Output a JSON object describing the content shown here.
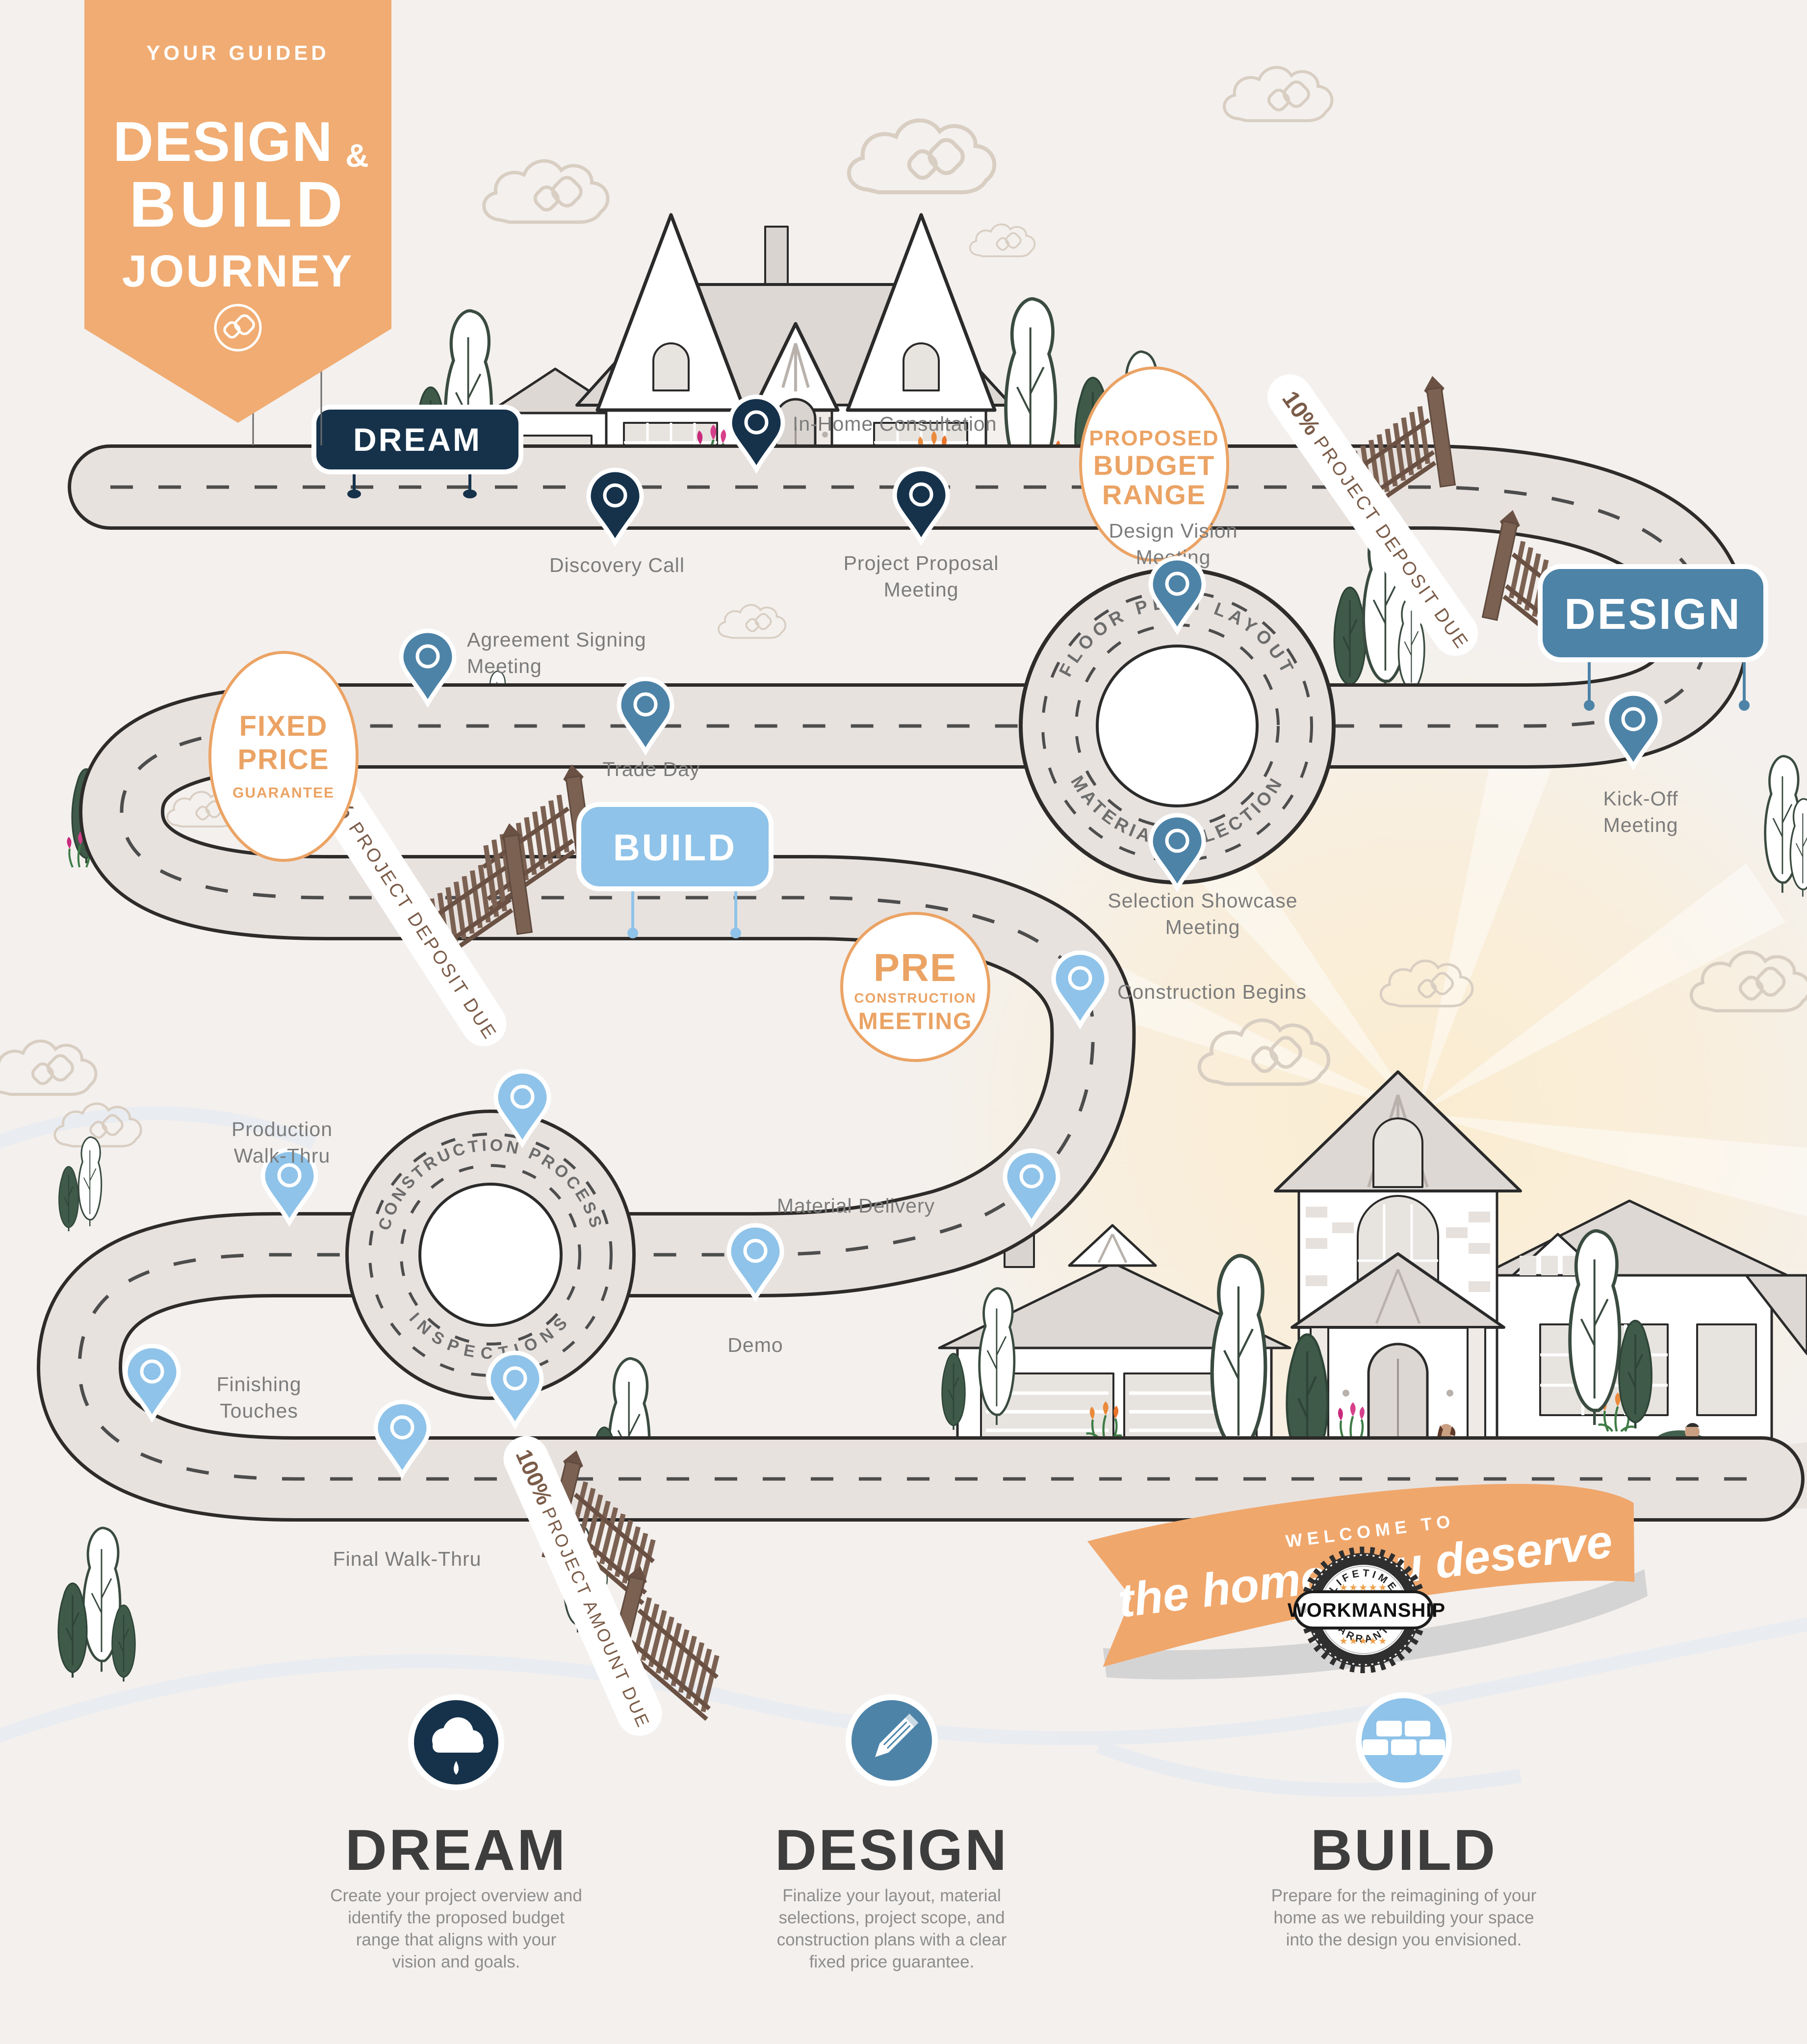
{
  "banner": {
    "kicker": "YOUR GUIDED",
    "line1": "DESIGN",
    "amp": "&",
    "line2": "BUILD",
    "line3": "JOURNEY",
    "logo_icon": "cb-monogram-icon"
  },
  "signs": {
    "dream": "DREAM",
    "design": "DESIGN",
    "build": "BUILD"
  },
  "milestones": {
    "in_home": "In-Home Consultation",
    "discovery": "Discovery Call",
    "proposal1": "Project Proposal",
    "proposal2": "Meeting",
    "design_vision1": "Design Vision",
    "design_vision2": "Meeting",
    "kick_off1": "Kick-Off",
    "kick_off2": "Meeting",
    "agreement1": "Agreement Signing",
    "agreement2": "Meeting",
    "trade_day": "Trade Day",
    "selection1": "Selection Showcase",
    "selection2": "Meeting",
    "construction_begins": "Construction Begins",
    "material_delivery": "Material Delivery",
    "demo": "Demo",
    "production1": "Production",
    "production2": "Walk-Thru",
    "finishing1": "Finishing",
    "finishing2": "Touches",
    "final_walk": "Final Walk-Thru"
  },
  "badges": {
    "budget": {
      "l1": "PROPOSED",
      "l2": "BUDGET",
      "l3": "RANGE"
    },
    "fixed": {
      "l1": "FIXED",
      "l2": "PRICE",
      "l3": "GUARANTEE"
    },
    "pre": {
      "l1": "PRE",
      "l2": "CONSTRUCTION",
      "l3": "MEETING"
    }
  },
  "payments": {
    "p10": {
      "pct": "10%",
      "label": "PROJECT DEPOSIT DUE"
    },
    "p50": {
      "pct": "50%",
      "label": "PROJECT DEPOSIT DUE"
    },
    "p100": {
      "pct": "100%",
      "label": "PROJECT AMOUNT DUE"
    }
  },
  "roundabouts": {
    "r1": {
      "top": "FLOOR PLAN LAYOUT",
      "bottom": "MATERIAL SELECTION"
    },
    "r2": {
      "top": "CONSTRUCTION PROCESS",
      "bottom": "INSPECTIONS"
    }
  },
  "ribbon": {
    "line1": "WELCOME TO",
    "line2": "the home you deserve"
  },
  "seal": {
    "top": "LIFETIME",
    "center": "WORKMANSHIP",
    "bottom": "WARRANTY",
    "stars_top": "★★★★★",
    "stars_bottom": "★★★★★"
  },
  "footer": {
    "dream": {
      "title": "DREAM",
      "icon": "cloud-icon",
      "lines": [
        "Create your project overview and",
        "identify the proposed budget",
        "range that aligns with your",
        "vision and goals."
      ]
    },
    "design": {
      "title": "DESIGN",
      "icon": "pencil-icon",
      "lines": [
        "Finalize your layout, material",
        "selections, project scope, and",
        "construction plans with a clear",
        "fixed price guarantee."
      ]
    },
    "build": {
      "title": "BUILD",
      "icon": "bricks-icon",
      "lines": [
        "Prepare for the reimagining of your",
        "home as we rebuilding your space",
        "into the design you envisioned."
      ]
    }
  },
  "colors": {
    "accent_orange": "#f0ac72",
    "navy": "#16324b",
    "steel_blue": "#4d83a7",
    "light_blue": "#8fc3e9",
    "road": "#e8e2df",
    "road_outline": "#2e2c2a",
    "label_gray": "#7c7c7c",
    "gate_brown": "#7b6152",
    "badge_orange": "#eba364"
  }
}
